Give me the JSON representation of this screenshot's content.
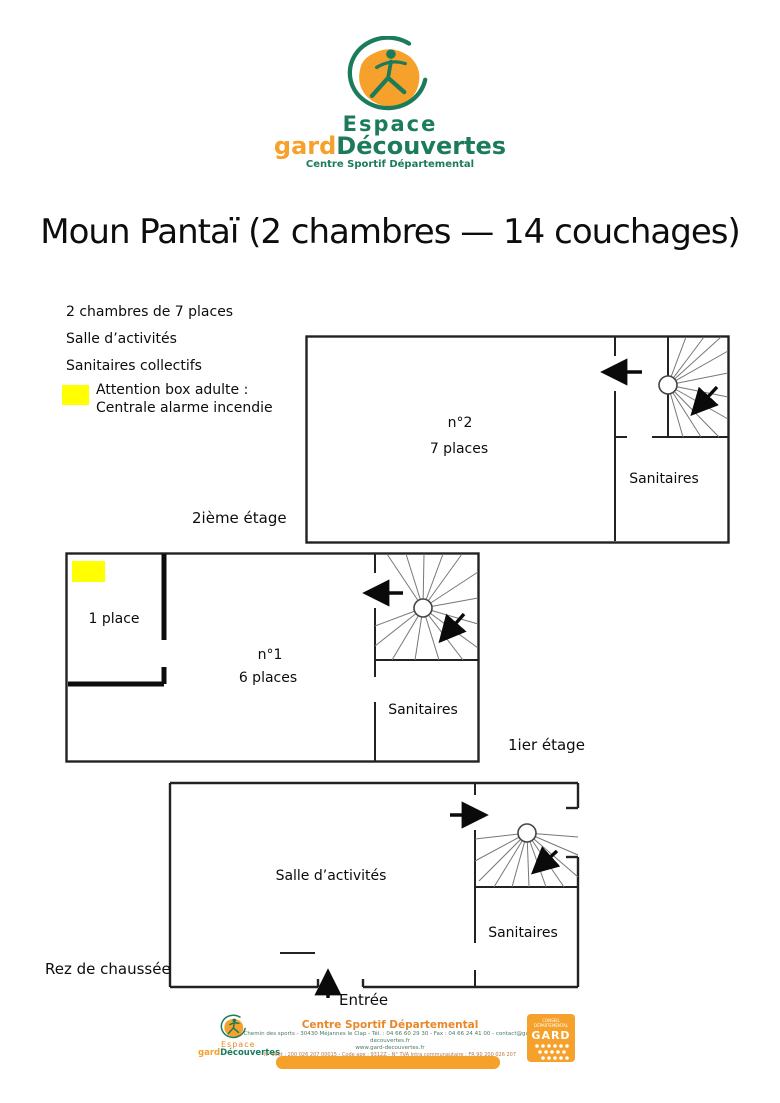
{
  "header": {
    "logo": {
      "espace": "Espace",
      "gard": "gard",
      "decouvertes": "Découvertes",
      "tagline": "Centre Sportif Départemental"
    },
    "title": "Moun Pantaï (2 chambres — 14 couchages)"
  },
  "info": {
    "items": [
      "2 chambres de 7 places",
      "Salle d’activités",
      "Sanitaires collectifs"
    ],
    "warning": {
      "line1": "Attention box adulte :",
      "line2": "Centrale alarme incendie",
      "swatch_color": "#ffff00"
    }
  },
  "plans": {
    "floor2": {
      "label": "2ième étage",
      "room": "n°2",
      "capacity": "7 places",
      "sanitaires": "Sanitaires"
    },
    "floor1": {
      "label": "1ier étage",
      "single_room": "1 place",
      "room": "n°1",
      "capacity": "6 places",
      "sanitaires": "Sanitaires"
    },
    "ground": {
      "label": "Rez de chaussée",
      "activity_room": "Salle d’activités",
      "sanitaires": "Sanitaires",
      "entrance": "Entrée"
    }
  },
  "footer": {
    "logo": {
      "espace": "Espace",
      "gard": "gard",
      "decouvertes": "Découvertes"
    },
    "center_title": "Centre Sportif Départemental",
    "address_line": "Chemin des sports - 30430 Méjannes le Clap - Tél. : 04 66 60 29 30 - Fax : 04 66 24 41 00 - contact@gard-decouvertes.fr",
    "website": "www.gard-decouvertes.fr",
    "legal_line": "N° siret : 200 026 207 00015 - Code ape : 9312Z - N° TVA Intra communautaire : FR 90 200 026 207",
    "gard_block": {
      "top_line1": "CONSEIL",
      "top_line2": "DÉPARTEMENTAL",
      "name": "GARD"
    }
  },
  "colors": {
    "green": "#1b7b5b",
    "orange": "#f5a12b",
    "yellow": "#ffff00",
    "ink": "#111111"
  }
}
